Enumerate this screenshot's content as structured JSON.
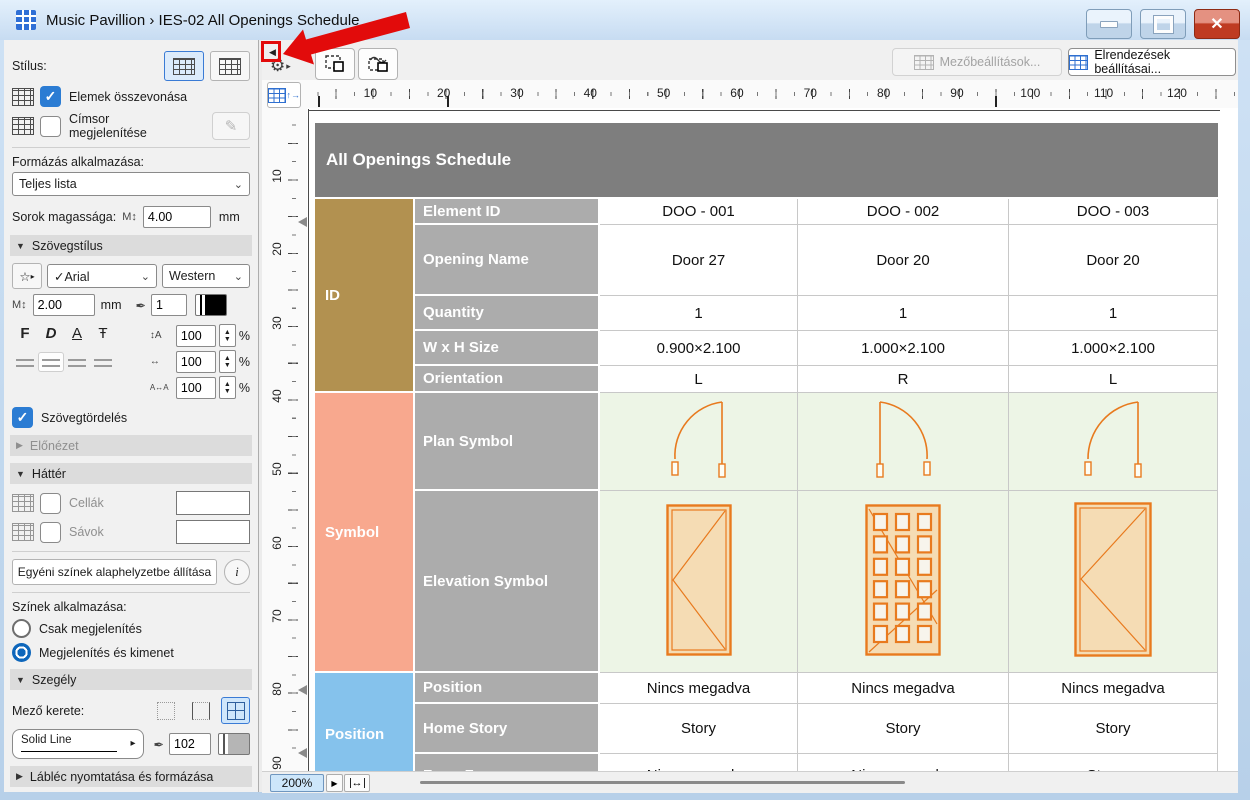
{
  "window": {
    "title": "Music Pavillion › IES-02 All Openings Schedule"
  },
  "annotation": {
    "color": "#e20b0b",
    "target": "panel-collapse-button"
  },
  "icons": {
    "collapse": "◀",
    "gear": "⚙",
    "flyout": "▸",
    "chevron_down": "⌄",
    "check": "✓",
    "pencil": "✎",
    "info": "i",
    "star": "☆",
    "pen": "✒",
    "m_height": "M↕",
    "spin_v": "↕A",
    "spin_w": "↔",
    "spin_t": "A↔A",
    "min": "—",
    "close": "✕",
    "fit_width": "↔",
    "small_arrow": "▶",
    "up": "▲",
    "down": "▼"
  },
  "sidebar": {
    "style_label": "Stílus:",
    "merge_label": "Elemek összevonása",
    "titlerow_label": "Címsor megjelenítése",
    "format_label": "Formázás alkalmazása:",
    "format_value": "Teljes lista",
    "row_height_label": "Sorok magassága:",
    "row_height_value": "4.00",
    "unit_mm": "mm",
    "pct": "%",
    "text_style_section": "Szövegstílus",
    "font_value": "✓Arial",
    "script_value": "Western",
    "size_value": "2.00",
    "pen1_value": "1",
    "bold": "F",
    "italic": "D",
    "underline": "A",
    "strike": "Ŧ",
    "spin": [
      "100",
      "100",
      "100"
    ],
    "wrap_label": "Szövegtördelés",
    "preview_section": "Előnézet",
    "background_section": "Háttér",
    "cells_label": "Cellák",
    "stripes_label": "Sávok",
    "reset_button": "Egyéni színek alaphelyzetbe állítása",
    "colors_label": "Színek alkalmazása:",
    "radio_display": "Csak megjelenítés",
    "radio_output": "Megjelenítés és kimenet",
    "border_section": "Szegély",
    "frame_label": "Mező kerete:",
    "line_value": "Solid Line",
    "pen2_value": "102",
    "footer_section": "Lábléc nyomtatása és formázása"
  },
  "toolbar": {
    "selected_label": "Kijelölve: 0",
    "editable_label": "Szerkeszthető: 0",
    "field_settings_button": "Mezőbeállítások...",
    "layout_settings_button": "Elrendezések beállításai..."
  },
  "ruler": {
    "h": [
      "10",
      "20",
      "30",
      "40",
      "50",
      "60",
      "70",
      "80",
      "90",
      "100",
      "110",
      "120"
    ],
    "v": [
      "10",
      "20",
      "30",
      "40",
      "50",
      "60",
      "70",
      "80",
      "90"
    ]
  },
  "statusbar": {
    "zoom": "200%"
  },
  "schedule": {
    "title": "All Openings Schedule",
    "groups": [
      {
        "label": "ID",
        "color": "#b29150"
      },
      {
        "label": "Symbol",
        "color": "#f8a88e"
      },
      {
        "label": "Position",
        "color": "#85c2ec"
      }
    ],
    "symbol_stroke": "#e87a1e",
    "symbol_fill": "#f5dcb4",
    "symbol_row_bg": "#edf5e6",
    "rows": [
      {
        "label": "Element ID",
        "values": [
          "DOO - 001",
          "DOO - 002",
          "DOO - 003"
        ]
      },
      {
        "label": "Opening Name",
        "values": [
          "Door 27",
          "Door 20",
          "Door 20"
        ]
      },
      {
        "label": "Quantity",
        "values": [
          "1",
          "1",
          "1"
        ]
      },
      {
        "label": "W x H Size",
        "values": [
          "0.900×2.100",
          "1.000×2.100",
          "1.000×2.100"
        ]
      },
      {
        "label": "Orientation",
        "values": [
          "L",
          "R",
          "L"
        ]
      },
      {
        "label": "Plan Symbol",
        "values": [
          "door-plan-swing-left",
          "door-plan-swing-right",
          "door-plan-swing-left"
        ]
      },
      {
        "label": "Elevation Symbol",
        "values": [
          "door-elevation-plain",
          "door-elevation-glazed",
          "door-elevation-plain"
        ]
      },
      {
        "label": "Position",
        "values": [
          "Nincs megadva",
          "Nincs megadva",
          "Nincs megadva"
        ]
      },
      {
        "label": "Home Story",
        "values": [
          "Story",
          "Story",
          "Story"
        ]
      },
      {
        "label": "From Zone",
        "values": [
          "<Nincs megadva>",
          "<Nincs megadva>",
          "Storage"
        ]
      }
    ]
  }
}
